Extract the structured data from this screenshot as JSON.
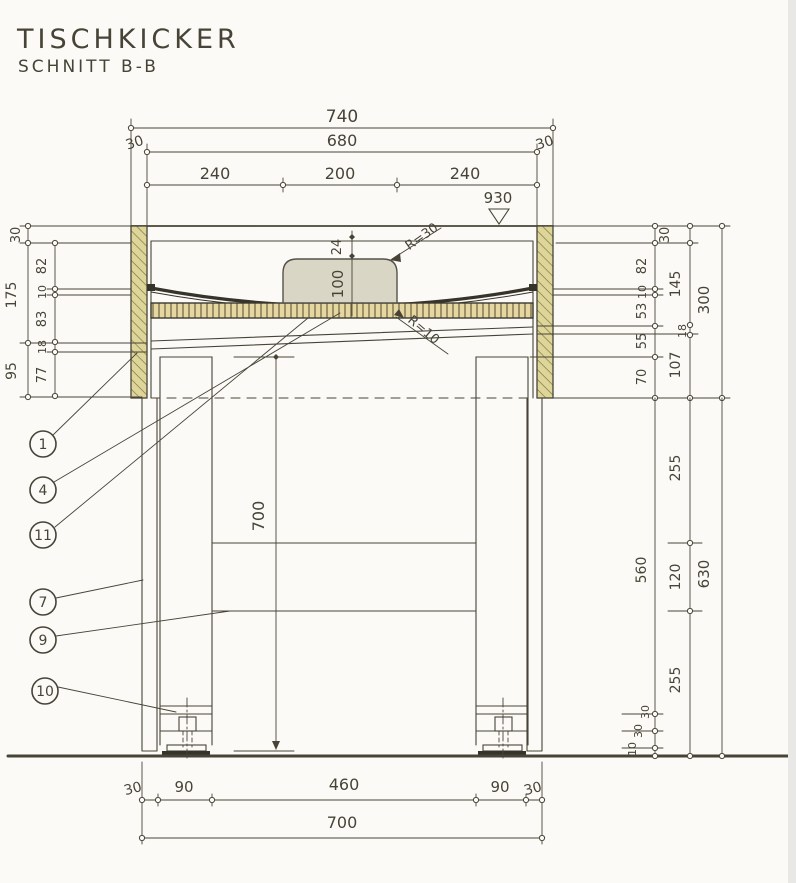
{
  "title": "TISCHKICKER",
  "subtitle": "SCHNITT B-B",
  "level_marker": "930",
  "dims": {
    "top": {
      "overall": "740",
      "margin_left": "30",
      "inner": "680",
      "margin_right": "30",
      "seg1": "240",
      "seg2": "200",
      "seg3": "240"
    },
    "hump": {
      "offset": "24",
      "height": "100",
      "radius_top": "R=30",
      "radius_bottom": "R=10"
    },
    "left_outer": [
      "30",
      "175",
      "95"
    ],
    "left_inner": [
      "82",
      "10",
      "83",
      "18",
      "77"
    ],
    "right_top_shared": "30",
    "right_top_inner": [
      "82",
      "10",
      "53",
      "55",
      "70"
    ],
    "right_top_middle": [
      "145",
      "18",
      "107"
    ],
    "right_top_overall": "300",
    "right_bottom_inner": [
      "560",
      "30",
      "30",
      "10"
    ],
    "right_bottom_middle": [
      "255",
      "120",
      "255"
    ],
    "right_bottom_overall": "630",
    "leg_height": "700",
    "bottom_chain": [
      "30",
      "90",
      "460",
      "90",
      "30"
    ],
    "bottom_overall": "700"
  },
  "parts": [
    "1",
    "4",
    "11",
    "7",
    "9",
    "10"
  ],
  "colors": {
    "paper": "#fbfaf6",
    "ink": "#474437",
    "wood": "#ded699",
    "wood_hatch": "#80764a",
    "board": "#e5d79f",
    "board_hatch": "#6b6145",
    "hump": "#d9d6c6",
    "edge_strip": "#e8e8e6"
  }
}
